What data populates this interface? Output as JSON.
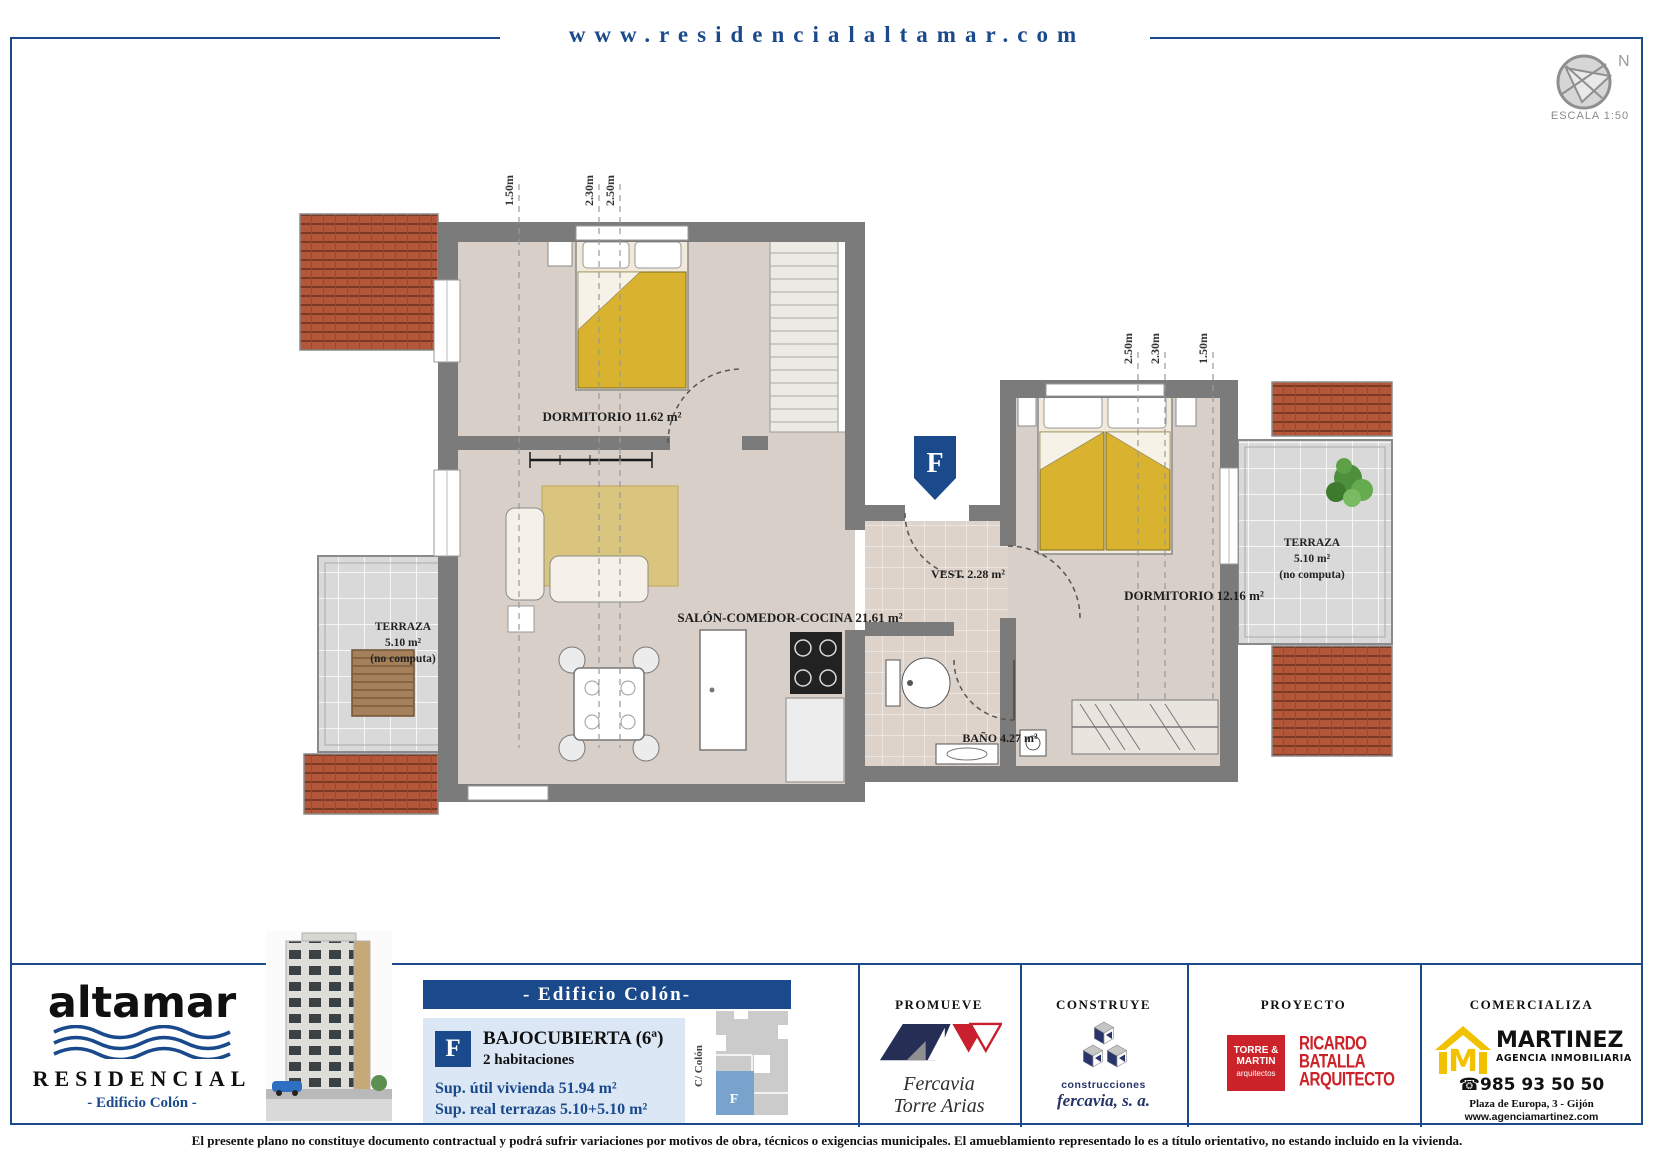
{
  "colors": {
    "accent": "#1a4a8c",
    "wall": "#7b7b7b",
    "floor": "#d8cfc8",
    "roof": "#b2573a",
    "bed_yellow": "#d9b32f",
    "panel_bg": "#dbe7f4",
    "map_blue": "#79a3cd",
    "logo_red": "#cc2229",
    "martinez_yellow": "#f2c200"
  },
  "header": {
    "url": "www.residencialaltamar.com"
  },
  "compass": {
    "north": "N",
    "scale": "ESCALA 1:50"
  },
  "plan": {
    "unit_marker": "F",
    "rooms": {
      "dormitorio1": "DORMITORIO 11.62 m²",
      "salon": "SALÓN-COMEDOR-COCINA 21.61 m²",
      "vestibulo": "VEST. 2.28 m²",
      "dormitorio2": "DORMITORIO 12.16 m²",
      "bano": "BAÑO 4.27 m²"
    },
    "terraza_left": {
      "l1": "TERRAZA",
      "l2": "5.10 m²",
      "l3": "(no computa)"
    },
    "terraza_right": {
      "l1": "TERRAZA",
      "l2": "5.10 m²",
      "l3": "(no computa)"
    },
    "dims_top": [
      "1.50m",
      "2.30m",
      "2.50m"
    ],
    "dims_right": [
      "2.50m",
      "2.30m",
      "1.50m"
    ]
  },
  "footer": {
    "brand": {
      "name": "altamar",
      "type": "RESIDENCIAL",
      "building": "- Edificio Colón -"
    },
    "unit_panel": {
      "title": "- Edificio Colón-",
      "letter": "F",
      "floor": "BAJOCUBIERTA (6ª)",
      "rooms": "2 habitaciones",
      "area1": "Sup. útil vivienda 51.94 m²",
      "area2": "Sup. real terrazas 5.10+5.10 m²",
      "street": "C/ Colón",
      "map_letter": "F"
    },
    "promueve": {
      "title": "PROMUEVE",
      "name1": "Fercavia",
      "name2": "Torre Arias"
    },
    "construye": {
      "title": "CONSTRUYE",
      "name1": "construcciones",
      "name2": "fercavia, s. a."
    },
    "proyecto": {
      "title": "PROYECTO",
      "studio1_l1": "TORRE &",
      "studio1_l2": "MARTIN",
      "studio1_l3": "arquitectos",
      "studio2_l1": "RICARDO",
      "studio2_l2": "BATALLA",
      "studio2_l3": "ARQUITECTO"
    },
    "comercializa": {
      "title": "COMERCIALIZA",
      "logo_letter": "M",
      "name": "MARTINEZ",
      "subtitle": "AGENCIA INMOBILIARIA",
      "phone_icon": "☎",
      "phone": "985 93 50 50",
      "address": "Plaza de Europa, 3 - Gijón",
      "web": "www.agenciamartinez.com"
    }
  },
  "disclaimer": "El presente plano no constituye documento contractual y podrá sufrir variaciones por motivos de obra, técnicos o exigencias municipales. El amueblamiento representado lo es a título orientativo, no estando incluido en la vivienda."
}
